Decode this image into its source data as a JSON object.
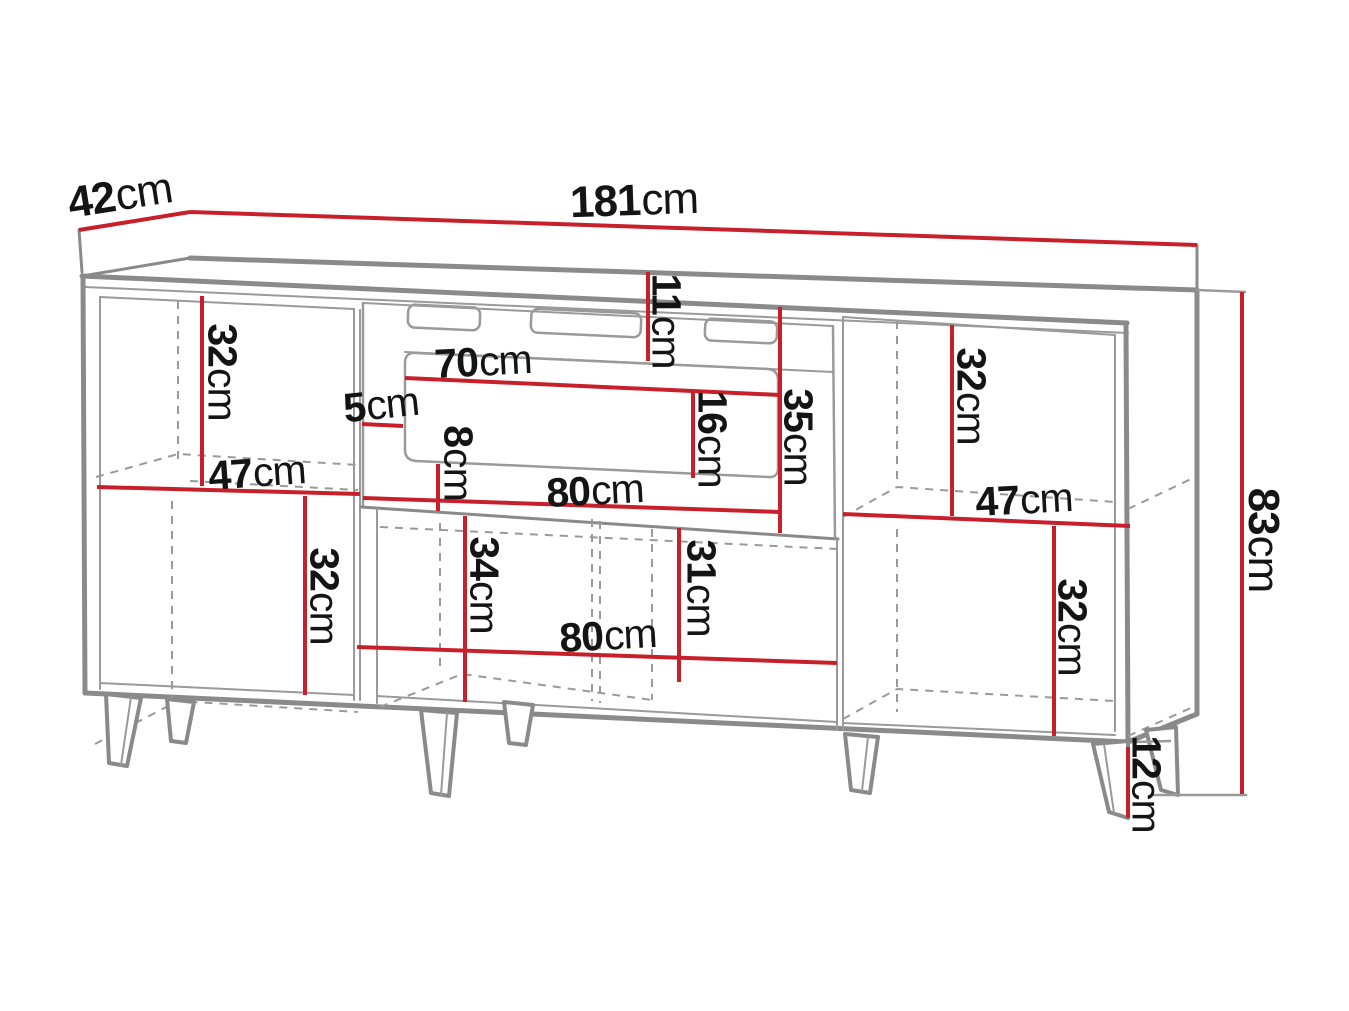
{
  "title": "Sideboard with electric fireplace — dimension diagram",
  "colors": {
    "red": "#c8202a",
    "outline": "#8a8a8a",
    "thin": "#9a9a9a",
    "text": "#141414",
    "bg": "#ffffff"
  },
  "dims": {
    "depth": {
      "num": "42",
      "unit": "cm"
    },
    "width": {
      "num": "181",
      "unit": "cm"
    },
    "height": {
      "num": "83",
      "unit": "cm"
    },
    "leg_height": {
      "num": "12",
      "unit": "cm"
    },
    "left_top_h": {
      "num": "32",
      "unit": "cm"
    },
    "left_w": {
      "num": "47",
      "unit": "cm"
    },
    "left_bottom_h": {
      "num": "32",
      "unit": "cm"
    },
    "vent_gap": {
      "num": "11",
      "unit": "cm"
    },
    "window_w": {
      "num": "70",
      "unit": "cm"
    },
    "side_gap": {
      "num": "5",
      "unit": "cm"
    },
    "under_gap": {
      "num": "8",
      "unit": "cm"
    },
    "window_h": {
      "num": "16",
      "unit": "cm"
    },
    "insert_h": {
      "num": "35",
      "unit": "cm"
    },
    "insert_w": {
      "num": "80",
      "unit": "cm"
    },
    "mid_left_h": {
      "num": "34",
      "unit": "cm"
    },
    "mid_right_h": {
      "num": "31",
      "unit": "cm"
    },
    "mid_w": {
      "num": "80",
      "unit": "cm"
    },
    "right_top_h": {
      "num": "32",
      "unit": "cm"
    },
    "right_w": {
      "num": "47",
      "unit": "cm"
    },
    "right_bottom_h": {
      "num": "32",
      "unit": "cm"
    }
  }
}
